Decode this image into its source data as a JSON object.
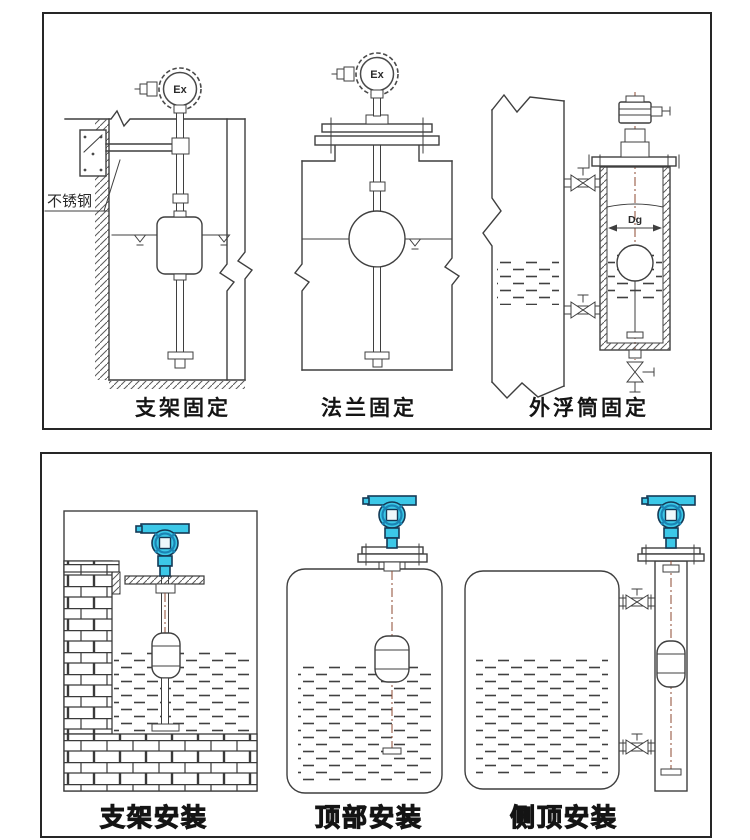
{
  "colors": {
    "ink": "#3f3f3f",
    "panel_border": "#262626",
    "caption": "#141414",
    "transmitter_cyan": "#3cc8e8",
    "transmitter_shade": "#1b84b4",
    "transmitter_outline": "#153a56",
    "stem_axis": "#8c4a32"
  },
  "top_panel": {
    "figures": [
      {
        "caption": "支架固定",
        "head_label": "Ex",
        "material_label": "不锈钢"
      },
      {
        "caption": "法兰固定",
        "head_label": "Ex"
      },
      {
        "caption": "外浮筒固定",
        "diameter_label": "Dg"
      }
    ]
  },
  "bottom_panel": {
    "figures": [
      {
        "caption": "支架安装"
      },
      {
        "caption": "顶部安装"
      },
      {
        "caption": "侧顶安装"
      }
    ]
  }
}
